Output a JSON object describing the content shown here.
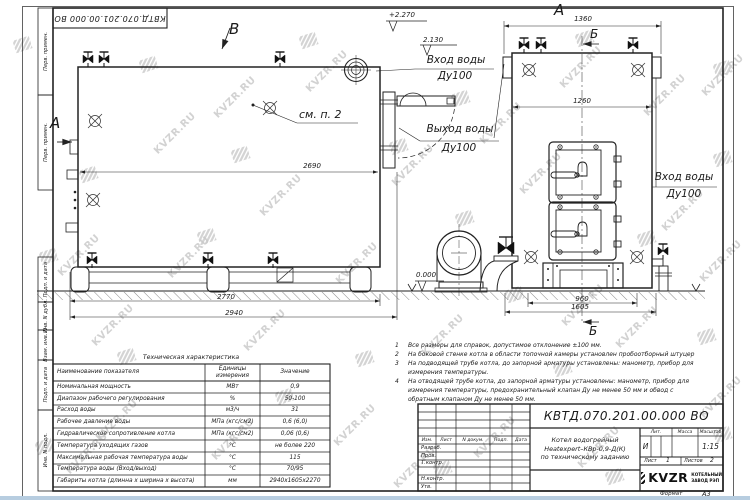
{
  "watermark": {
    "text": "KVZR.RU"
  },
  "stamp": {
    "designation": "КВТД.070.201.00.000 ВО"
  },
  "margin_labels": [
    "Перв. примен.",
    "Перв. примен.",
    "Подп. и дата",
    "Инв. N дубл.",
    "Взам. инв. N",
    "Подп. и дата",
    "Инв. N подл."
  ],
  "views": {
    "a_side": "А",
    "a_front": "А",
    "b_top": "Б",
    "b_bottom": "Б",
    "v": "В",
    "see_note": "см. п. 2"
  },
  "dims": {
    "len_body": "2690",
    "len_skid": "2770",
    "len_total": "2940",
    "w_total": "1360",
    "w_body": "1260",
    "w_skid": "960",
    "w_base": "1605"
  },
  "elevations": {
    "top": "+2.270",
    "mid": "2.130",
    "ground": "0.000"
  },
  "pipes": {
    "inlet_top": {
      "line1": "Вход воды",
      "line2": "Ду100"
    },
    "outlet": {
      "line1": "Выход воды",
      "line2": "Ду100"
    },
    "inlet_right": {
      "line1": "Вход воды",
      "line2": "Ду100"
    }
  },
  "tech_table": {
    "title": "Техническая характеристика",
    "headers": {
      "name": "Наименование показателя",
      "unit": "Единицы измерения",
      "value": "Значение"
    },
    "rows": [
      {
        "name": "Номинальная мощность",
        "unit": "МВт",
        "value": "0,9"
      },
      {
        "name": "Диапазон рабочего регулирования",
        "unit": "%",
        "value": "50-100"
      },
      {
        "name": "Расход воды",
        "unit": "м3/ч",
        "value": "31"
      },
      {
        "name": "Рабочее давление воды",
        "unit": "МПа (кгс/см2)",
        "value": "0,6 (6,0)"
      },
      {
        "name": "Гидравлическое сопротивление котла",
        "unit": "МПа (кгс/см2)",
        "value": "0,06 (0,6)"
      },
      {
        "name": "Температура уходящих газов",
        "unit": "°С",
        "value": "не более 220"
      },
      {
        "name": "Максимальная рабочая температура воды",
        "unit": "°С",
        "value": "115"
      },
      {
        "name": "Температура воды (Вход/выход)",
        "unit": "°С",
        "value": "70/95"
      },
      {
        "name": "Габариты котла (длинна х ширина х высота)",
        "unit": "мм",
        "value": "2940х1605х2270"
      }
    ]
  },
  "notes": {
    "items": [
      {
        "num": "1",
        "text": "Все размеры для справок, допустимое отклонение ±100 мм."
      },
      {
        "num": "2",
        "text": "На боковой стенке котла в области топочной камеры установлен пробоотборный штуцер"
      },
      {
        "num": "3",
        "text": "На подводящей трубе котла, до запорной арматуры установлены: манометр, прибор для измерения температуры."
      },
      {
        "num": "4",
        "text": "На отводящей трубе котла, до запорной арматуры установлены: манометр, прибор для измерения температуры, предохранительный клапан Ду не менее 50 мм и обвод с обратным клапаном Ду не менее 50 мм."
      }
    ]
  },
  "title_block": {
    "designation": "КВТД.070.201.00.000 ВО",
    "product_name": {
      "line1": "Котел водогрейный",
      "line2": "Heatexpert–КВр-0,9-Д(К)",
      "line3": "по техническому заданию"
    },
    "header_cells": {
      "izm": "Изм.",
      "list": "Лист",
      "doc": "N докум.",
      "podp": "Подп.",
      "data": "Дата"
    },
    "row_labels": {
      "razrab": "Разраб.",
      "prov": "Пров.",
      "tkontr": "Т.контр.",
      "nkontr": "Н.контр.",
      "utv": "Утв."
    },
    "lit": {
      "label": "Лит.",
      "value": "И"
    },
    "mass": {
      "label": "Масса"
    },
    "scale": {
      "label": "Масштаб",
      "value": "1:15"
    },
    "sheet": {
      "label": "Лист",
      "value": "1"
    },
    "sheets": {
      "label": "Листов",
      "value": "2"
    },
    "company": {
      "logo": "KVZR",
      "line1": "КОТЕЛЬНЫЙ",
      "line2": "ЗАВОД РЭП"
    },
    "format": {
      "label": "Формат",
      "value": "А3"
    }
  },
  "colors": {
    "line": "#222222",
    "watermark": "#c7c7c7",
    "bottom_strip": "#b7cde0"
  }
}
